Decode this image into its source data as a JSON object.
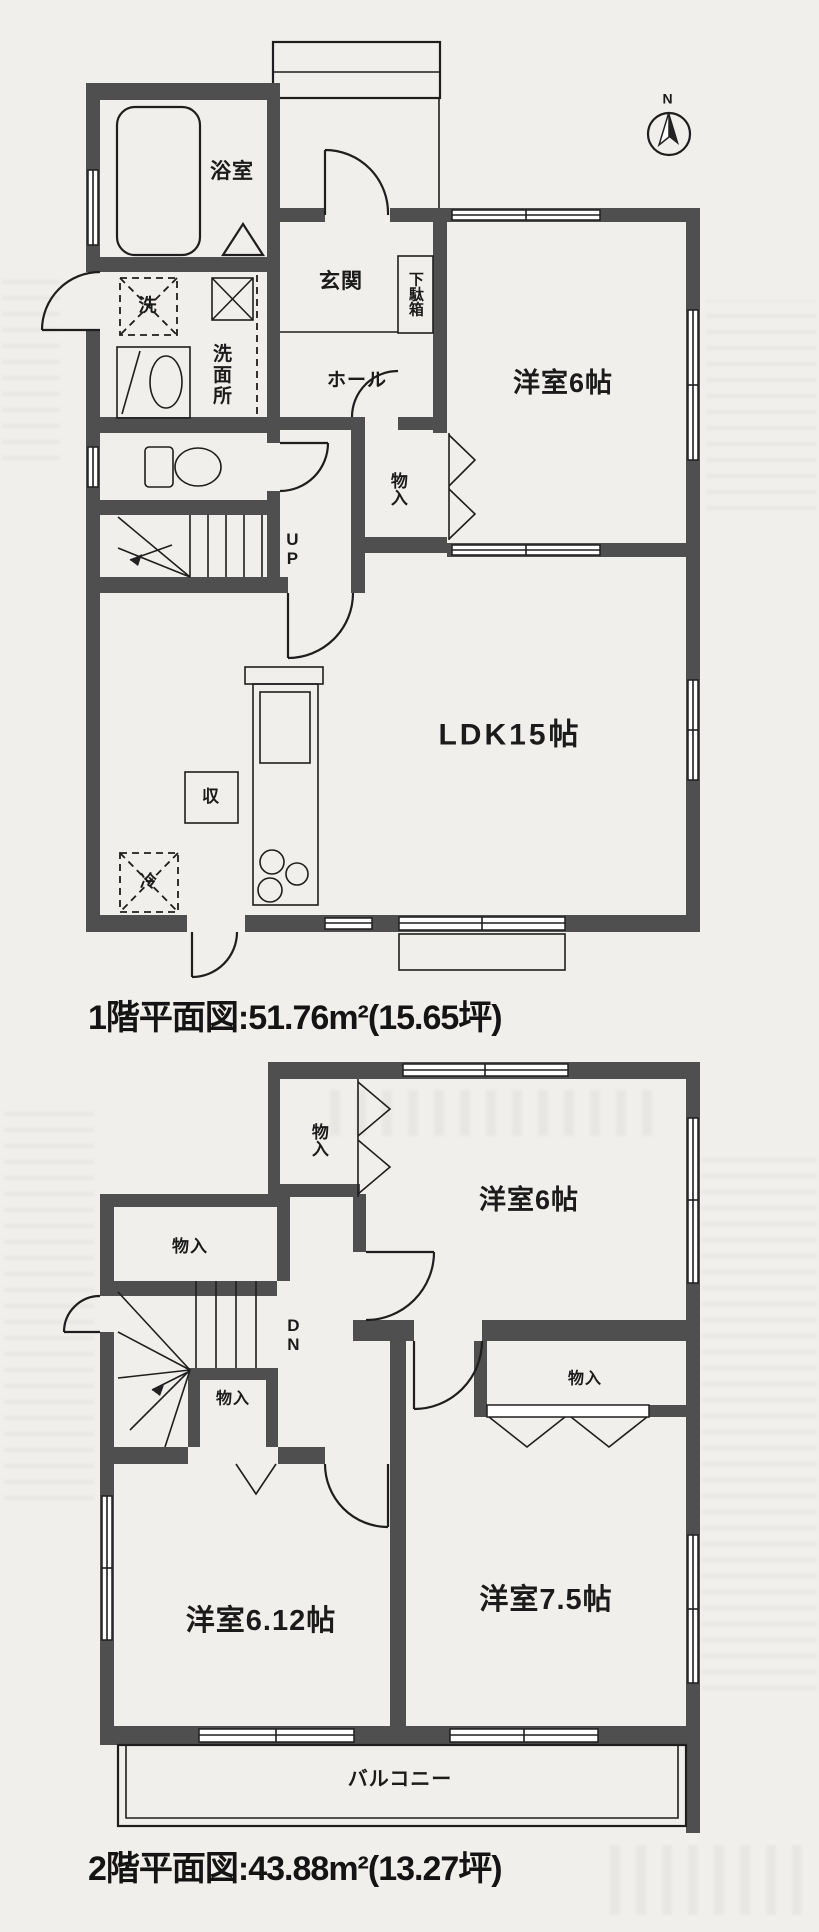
{
  "floor1": {
    "caption": "1階平面図:51.76m²(15.65坪)",
    "compass": "N",
    "labels": {
      "bathroom": "浴室",
      "washer": "洗",
      "washroom": "洗面所",
      "entrance": "玄関",
      "shoe_cabinet": "下駄箱",
      "hall": "ホール",
      "western_room6": "洋室6帖",
      "closet": "物入",
      "stairs_up": "UP",
      "ldk": "LDK15帖",
      "storage": "収",
      "refrigerator": "冷"
    }
  },
  "floor2": {
    "caption": "2階平面図:43.88m²(13.27坪)",
    "labels": {
      "closet_top": "物入",
      "western_room6": "洋室6帖",
      "closet_left": "物入",
      "stairs_down": "DN",
      "closet_mid": "物入",
      "closet_right": "物入",
      "western_room612": "洋室6.12帖",
      "western_room75": "洋室7.5帖",
      "balcony": "バルコニー"
    }
  }
}
